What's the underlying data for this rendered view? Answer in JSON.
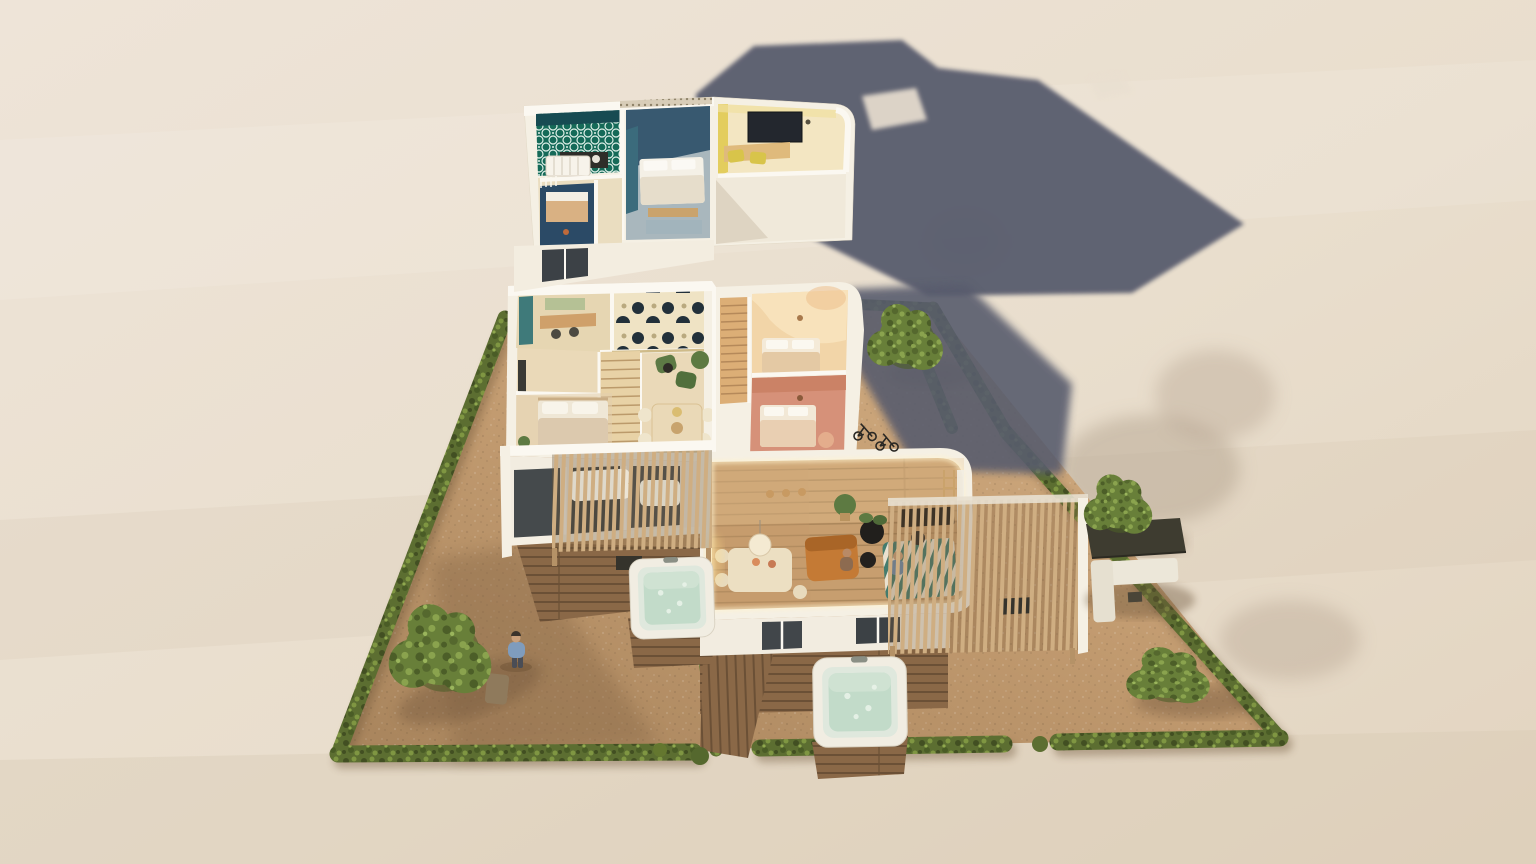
{
  "scene": {
    "type": "3d-cutaway-floor-plan-render",
    "labels": {
      "upper_floor": "floating upper floor slab",
      "ground_floor": "ground floor of duplex",
      "unit_a": "left unit - cream interior",
      "unit_b": "right unit - pink interior",
      "plot": "gravel plot with hedge border",
      "left_garden": "left gravel garden",
      "right_garden": "right gravel garden",
      "courtyard": "bike courtyard",
      "pergola_left": "left timber pergola",
      "pergola_right": "right timber pergola",
      "hot_tub_left": "hot tub beside left deck",
      "hot_tub_front": "hot tub on front terrace",
      "outdoor_lounge": "canopied outdoor lounge",
      "boardwalk": "timber boardwalk",
      "shadow_upper": "shadow cast by upper floor",
      "shadow_right": "shadow cast on right courtyard"
    },
    "levels": [
      {
        "name": "upper-floor",
        "rooms": [
          "green-tile-bathroom",
          "kids-room-navy",
          "main-bedroom-navy-teal",
          "landing",
          "home-office-yellow"
        ]
      },
      {
        "name": "ground-floor",
        "units": [
          {
            "name": "unit-a",
            "rooms": [
              "study-nook-teal",
              "patterned-lounge",
              "staircase",
              "dining-area",
              "bedroom"
            ]
          },
          {
            "name": "unit-b",
            "rooms": [
              "timber-staircase",
              "bedroom-peach",
              "bedroom-pink",
              "kitchen-black",
              "living-dining-wood"
            ]
          }
        ]
      }
    ],
    "exterior_objects": [
      "hedge-border",
      "gravel-yard",
      "wood-deck",
      "boardwalk",
      "pergola-left",
      "pergola-right",
      "hot-tub-left",
      "hot-tub-front",
      "outdoor-lounge-canopy",
      "garden-bench",
      "garden-chair",
      "bicycles",
      "trees",
      "person-standing",
      "person-at-desk",
      "person-on-sofa"
    ],
    "counts": {
      "hot_tubs": 2,
      "pergolas": 2,
      "people": 3,
      "bicycles": 2,
      "trees": 4,
      "units": 2
    }
  },
  "palette": {
    "bg1": "#eee4d8",
    "bg2": "#e9decd",
    "bg3": "#e0d2be",
    "slate": "#585c6d",
    "gravel": "#c39c72",
    "gravelLight": "#d6b287",
    "gravelDark": "#a8845c",
    "gravelShadow": "#7c5f42",
    "hedge": "#5c6e31",
    "hedgeDark": "#424f22",
    "hedgeLight": "#7f9642",
    "tree": "#687f39",
    "treeLight": "#8aa34e",
    "treeDark": "#4c5e28",
    "wall": "#f5f0e4",
    "wallBright": "#fbf8f1",
    "wallShade": "#e6ddcc",
    "floorCream": "#ead9b8",
    "floorNook": "#e6d6b2",
    "patternInk": "#22303a",
    "teal": "#3f6f80",
    "navy": "#2d4d66",
    "steel": "#a9b7bd",
    "greenTile": "#156a58",
    "yellow": "#e3cd5d",
    "officeFloor": "#f3e6c2",
    "peachFloor": "#f2d5a8",
    "peachWall": "#f8e3bd",
    "arch": "#edbf8c",
    "pinkFloor": "#d69179",
    "pinkWall": "#c97f63",
    "woodStair": "#dcae76",
    "woodFloor": "#c79e6f",
    "woodDark": "#a9855a",
    "deck": "#8a6847",
    "deckDark": "#6b5036",
    "slat": "#cfae82",
    "kitchen": "#26231f",
    "sofa": "#c47a35",
    "sofaDark": "#a96527",
    "mint": "#c2dbc9",
    "mintRim": "#dfe8dd",
    "tubShell": "#f1ede2",
    "plant": "#5d7a42",
    "canopy": "#3e3c30",
    "loungeSofa": "#ece7d9",
    "person": "#7f9cbd",
    "glow": "#fff3cf"
  }
}
